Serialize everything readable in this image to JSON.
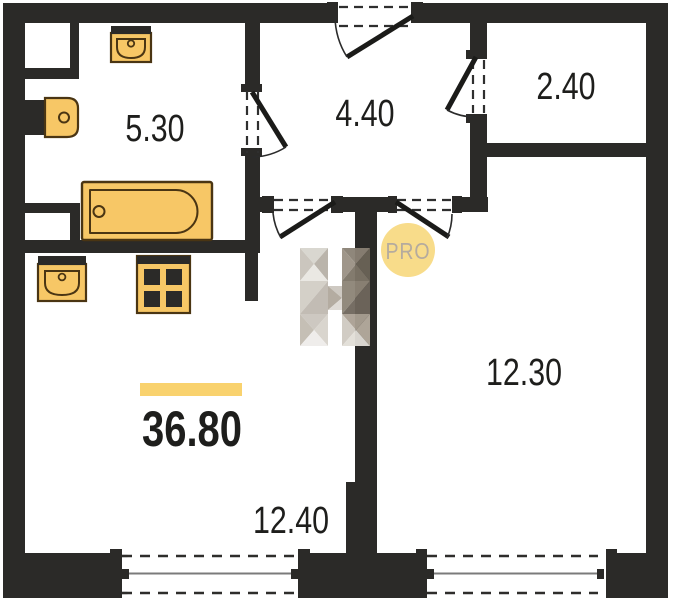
{
  "floor_plan": {
    "total_area_label": "36.80",
    "rooms": {
      "bathroom": {
        "area": "5.30"
      },
      "hallway": {
        "area": "4.40"
      },
      "closet": {
        "area": "2.40"
      },
      "bedroom": {
        "area": "12.30"
      },
      "living_room": {
        "area": "12.40"
      }
    },
    "watermark_badge": "PRO",
    "fixtures": [
      "wash-basin-icon",
      "toilet-icon",
      "bathtub-icon",
      "kitchen-sink-icon",
      "stove-icon"
    ],
    "colors": {
      "wall": "#2b2a28",
      "background": "#ffffff",
      "fixture_fill": "#f7c766",
      "fixture_outline": "#4a3513",
      "accent_bar": "#f9d26e",
      "badge_circle": "#f8dc8a",
      "badge_text": "#b5ab9e",
      "label_text": "#1e1e1c",
      "window_glass_line": "#7b7b7b",
      "door_line": "#1b1b19"
    }
  }
}
